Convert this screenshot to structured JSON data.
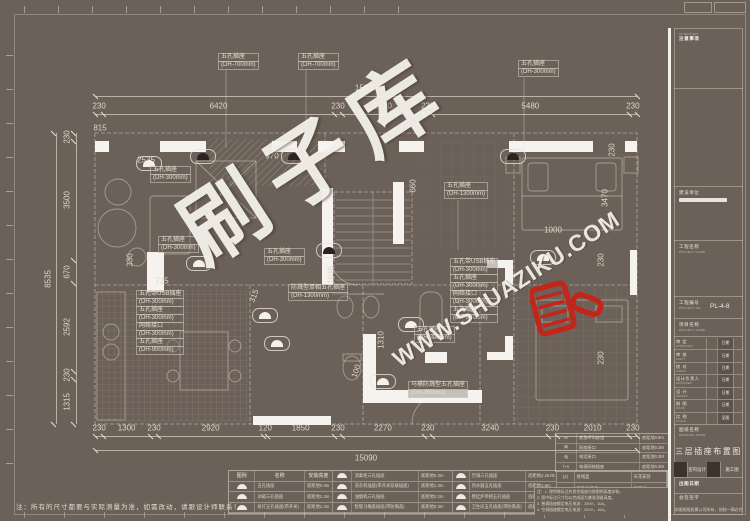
{
  "colors": {
    "background": "#6C6158",
    "ink": "#DDD6CB",
    "wall_white": "#F6F3EE",
    "brand_red": "#C2251A"
  },
  "watermark": {
    "brand": "刷子库",
    "url": "WWW.SHUAZIKU.COM",
    "brush_icon": "red-paint-brush"
  },
  "note": "注：所有的尺寸都要与实际测量为准，如需改动，请跟设计师联系！",
  "dimensions": {
    "top_total": "15090",
    "bottom_total": "15090",
    "left_total": "8535",
    "top": [
      230,
      6420,
      230,
      2270,
      230,
      5480,
      230
    ],
    "bottom": [
      230,
      1300,
      230,
      2920,
      120,
      1850,
      230,
      2270,
      230,
      3240,
      230,
      2010,
      230
    ],
    "left": [
      230,
      3500,
      670,
      2592,
      230,
      1315
    ],
    "free": [
      {
        "t": "815",
        "x": 100,
        "y": 128,
        "r": 0
      },
      {
        "t": "2535",
        "x": 146,
        "y": 160,
        "r": 0
      },
      {
        "t": "970",
        "x": 272,
        "y": 156,
        "r": 0
      },
      {
        "t": "725",
        "x": 162,
        "y": 281,
        "r": 0
      },
      {
        "t": "315",
        "x": 254,
        "y": 296,
        "r": -70
      },
      {
        "t": "330",
        "x": 130,
        "y": 260,
        "r": -90
      },
      {
        "t": "1646",
        "x": 331,
        "y": 275,
        "r": -90
      },
      {
        "t": "1310",
        "x": 381,
        "y": 340,
        "r": -90
      },
      {
        "t": "100",
        "x": 356,
        "y": 371,
        "r": -70
      },
      {
        "t": "660",
        "x": 413,
        "y": 186,
        "r": -90
      },
      {
        "t": "1000",
        "x": 553,
        "y": 230,
        "r": 0
      },
      {
        "t": "3470",
        "x": 605,
        "y": 198,
        "r": -90
      },
      {
        "t": "230",
        "x": 612,
        "y": 150,
        "r": -90
      },
      {
        "t": "230",
        "x": 601,
        "y": 260,
        "r": -90
      },
      {
        "t": "230",
        "x": 601,
        "y": 358,
        "r": -90
      }
    ]
  },
  "callouts": [
    {
      "x": 218,
      "y": 54,
      "lines": [
        "五孔插座",
        "(DH-700mm)"
      ]
    },
    {
      "x": 298,
      "y": 54,
      "lines": [
        "五孔插座",
        "(DH-700mm)"
      ]
    },
    {
      "x": 518,
      "y": 61,
      "lines": [
        "五孔插座",
        "(DH-300mm)"
      ]
    },
    {
      "x": 150,
      "y": 167,
      "lines": [
        "五孔插座",
        "(DH-300mm)"
      ]
    },
    {
      "x": 158,
      "y": 237,
      "lines": [
        "五孔插座",
        "(DH-300mm)"
      ]
    },
    {
      "x": 264,
      "y": 249,
      "lines": [
        "五孔插座",
        "(DH-300mm)"
      ]
    },
    {
      "x": 444,
      "y": 183,
      "lines": [
        "五孔插座",
        "(DH-1300mm)"
      ]
    },
    {
      "x": 288,
      "y": 285,
      "lines": [
        "防溅型单相五孔插座",
        "(DH-1300mm)"
      ]
    },
    {
      "x": 136,
      "y": 291,
      "lines": [
        "五孔带USB插座",
        "(DH-300mm)",
        "五孔插座",
        "(DH-300mm)",
        "网络接口",
        "(DH-300mm)",
        "五孔插座",
        "(DH-900mm)"
      ]
    },
    {
      "x": 450,
      "y": 259,
      "lines": [
        "五孔带USB插座",
        "(DH-300mm)",
        "五孔插座",
        "(DH-300mm)",
        "网络接口",
        "(DH-300mm)",
        "五孔插座",
        "(DH-900mm)"
      ]
    },
    {
      "x": 414,
      "y": 327,
      "lines": [
        "五孔插座",
        "(DH-300mm)"
      ]
    },
    {
      "x": 408,
      "y": 382,
      "lines": [
        "马桶防溅型五孔插座",
        "(DH-300mm)"
      ]
    }
  ],
  "sockets": [
    {
      "x": 136,
      "y": 156,
      "dark": 0
    },
    {
      "x": 190,
      "y": 149,
      "dark": 1
    },
    {
      "x": 281,
      "y": 149,
      "dark": 1
    },
    {
      "x": 500,
      "y": 149,
      "dark": 1
    },
    {
      "x": 316,
      "y": 243,
      "dark": 1
    },
    {
      "x": 186,
      "y": 256,
      "dark": 0
    },
    {
      "x": 252,
      "y": 308,
      "dark": 0
    },
    {
      "x": 264,
      "y": 336,
      "dark": 0
    },
    {
      "x": 398,
      "y": 317,
      "dark": 0
    },
    {
      "x": 530,
      "y": 250,
      "dark": 0
    },
    {
      "x": 370,
      "y": 374,
      "dark": 0
    }
  ],
  "legend": {
    "headers": [
      "图例",
      "名称",
      "安装高度"
    ],
    "col1": [
      [
        "五孔插座",
        "底距地0.3m"
      ],
      [
        "冰箱三孔插座",
        "底距地1.3m"
      ],
      [
        "射灯五孔插座(带开关)",
        "底距地1.3m"
      ]
    ],
    "col2": [
      [
        "消毒柜三孔插座",
        "底距地0.3m"
      ],
      [
        "洗衣机插座(带开关双联插座)",
        "底距地1.3m"
      ],
      [
        "油烟机三孔插座",
        "底距地2.2m"
      ],
      [
        "智能马桶盖插座(带防溅盖)",
        "底距地0.3m"
      ]
    ],
    "col3": [
      [
        "空调三孔插座",
        "底距地2.2m/0.3m"
      ],
      [
        "热水器五孔插座",
        "底距地1.8m"
      ],
      [
        "壁挂炉单相五孔插座",
        "底距地0.6m"
      ],
      [
        "卫生间五孔插座(带防溅盖)",
        "底距地1.3m"
      ]
    ],
    "col4": [
      [
        "接线盒",
        "天花安装"
      ],
      [
        "五孔地插座",
        "底距地0.3m"
      ]
    ],
    "col4_syms": [
      "(J)",
      "⊓"
    ],
    "notes": [
      "注：1. 除特殊标注外其余插座均按图例高度安装。",
      "2. 图中标注尺寸均以完成面为基准测量高度。",
      "3. 普通插座额定电压电流：250V，10A。",
      "4. 空调插座额定电压电流：250V，16A。"
    ]
  },
  "mini_table": {
    "syms": [
      "▪▪▪",
      "网",
      "电",
      "T+V"
    ],
    "rows": [
      [
        "紧急呼叫按钮",
        "底距地0.9m"
      ],
      [
        "网络接口",
        "底距地0.3M"
      ],
      [
        "电话接口",
        "底距地0.3M"
      ],
      [
        "电视网络插座",
        "底距地0.3M"
      ]
    ]
  },
  "title_block": {
    "attention_en": "ATTENTION",
    "attention_cn": "注意事项",
    "owner_label": "建设单位",
    "project_name_label": "工程名称",
    "project_name_en": "PROJECT NAME",
    "project_no_label": "工程编号",
    "project_no_en": "PROJECT NO.",
    "project_no": "PL-4-8",
    "item_label": "项目名称",
    "item_en": "PROJECT NAME",
    "rows": [
      {
        "label": "审 定",
        "en": "APPROVED",
        "right": "日期"
      },
      {
        "label": "审 核",
        "en": "AUDIT",
        "right": "日期"
      },
      {
        "label": "校 对",
        "en": "CHECK",
        "right": "日期"
      },
      {
        "label": "设计负责人",
        "en": "DESIGNER",
        "right": "日期"
      },
      {
        "label": "设 计",
        "en": "DESIGN",
        "right": "日期"
      },
      {
        "label": "制 图",
        "en": "DRAW",
        "right": "日期"
      },
      {
        "label": "比 例",
        "en": "SCALE",
        "right": "见图"
      }
    ],
    "drawing_name_label": "图纸名称",
    "drawing_name_en": "DRAWING NAME",
    "drawing_name": "三层插座布置图",
    "stage_cells": [
      "室内设计",
      "施工图"
    ],
    "issue_label": "出图日期",
    "sign_label": "会签签字",
    "copyright": "本图纸版权属公司所有，仿制一律必究"
  }
}
